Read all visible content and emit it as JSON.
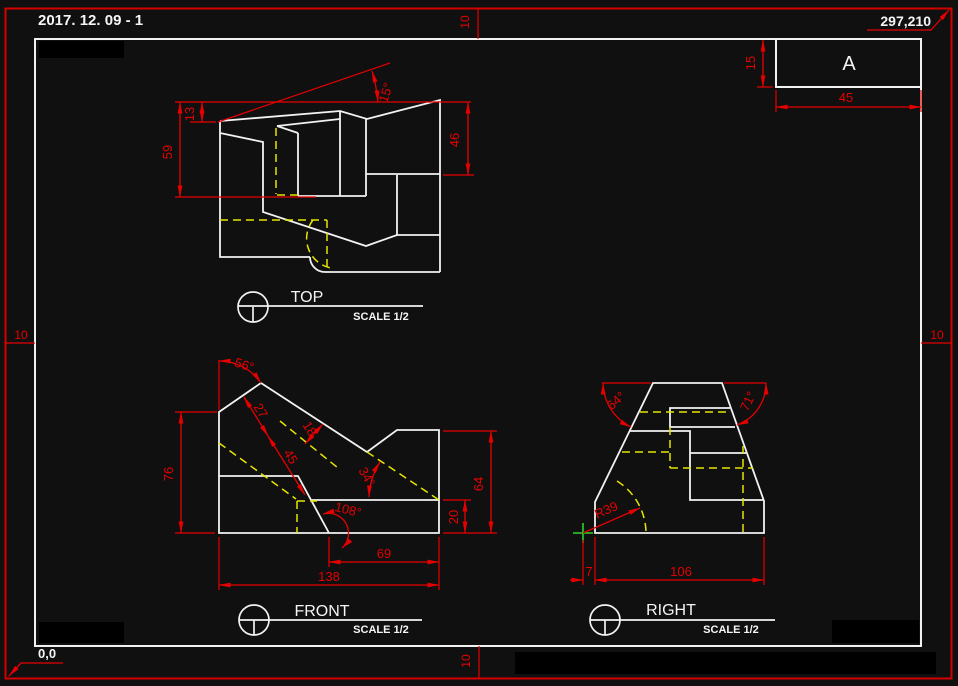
{
  "canvas": {
    "background": "#101010",
    "geometry_color": "#f2f2f2",
    "dimension_color": "#e60000",
    "hidden_line_color": "#e6e600",
    "origin_marker_color": "#2bd42b"
  },
  "annotations": {
    "date_note": "2017. 12. 09 - 1",
    "paper_coord": "297,210",
    "origin_coord": "0,0",
    "margin_top": "10",
    "margin_bottom": "10",
    "margin_left": "10",
    "margin_right": "10"
  },
  "title_block": {
    "zone_label": "A",
    "height_dim": "15",
    "width_dim": "45"
  },
  "views": {
    "top": {
      "label": "TOP",
      "scale": "SCALE 1/2",
      "dim_13": "13",
      "dim_59": "59",
      "dim_46": "46",
      "ang_15": "15°"
    },
    "front": {
      "label": "FRONT",
      "scale": "SCALE 1/2",
      "ang_56": "56°",
      "dim_27": "27",
      "dim_18": "18",
      "dim_45": "45",
      "ang_34": "34°",
      "ang_108": "108°",
      "dim_76": "76",
      "dim_64": "64",
      "dim_20": "20",
      "dim_69": "69",
      "dim_138": "138"
    },
    "right": {
      "label": "RIGHT",
      "scale": "SCALE 1/2",
      "ang_64": "64°",
      "ang_71": "71°",
      "rad_39": "R39",
      "dim_7": "7",
      "dim_106": "106"
    }
  }
}
